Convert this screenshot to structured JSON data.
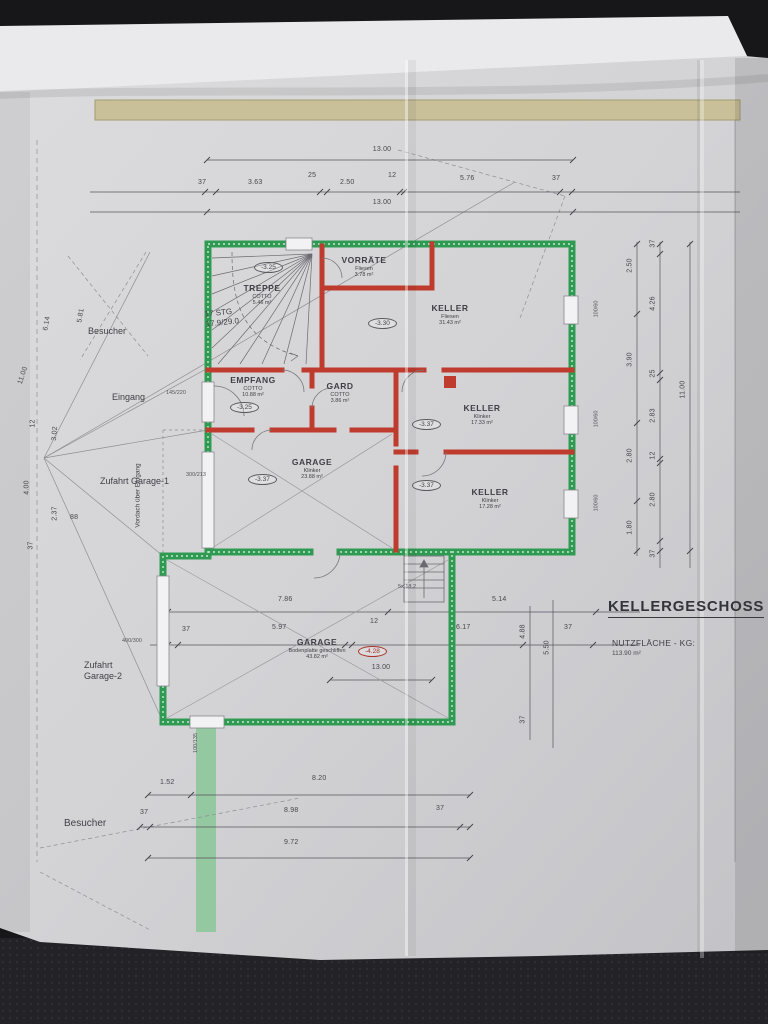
{
  "drawing": {
    "title": "KELLERGESCHOSS",
    "area_label": "NUTZFLÄCHE - KG:",
    "area_value": "113.90 m²"
  },
  "rooms": [
    {
      "name": "TREPPE",
      "finish": "COTTO",
      "area": "5.46 m²",
      "level": "-3.25"
    },
    {
      "name": "VORRÄTE",
      "finish": "Fliesen",
      "area": "3.78 m²"
    },
    {
      "name": "KELLER",
      "finish": "Fliesen",
      "area": "31.43 m²",
      "level": "-3.30"
    },
    {
      "name": "EMPFANG",
      "finish": "COTTO",
      "area": "10.88 m²",
      "level": "-3.25"
    },
    {
      "name": "GARD",
      "finish": "COTTO",
      "area": "3.86 m²"
    },
    {
      "name": "KELLER",
      "finish": "Klinker",
      "area": "17.33 m²",
      "level": "-3.37"
    },
    {
      "name": "GARAGE",
      "finish": "Klinker",
      "area": "23.88 m²",
      "level": "-3.37"
    },
    {
      "name": "KELLER",
      "finish": "Klinker",
      "area": "17.28 m²",
      "level": "-3.37"
    },
    {
      "name": "GARAGE",
      "finish": "Bodenplatte geschliffen",
      "area": "43.82 m²",
      "level": "-4.28"
    }
  ],
  "stair": {
    "count": "17 STG",
    "rise_run": "17.9/29.0",
    "outside_steps": "5x 18.2"
  },
  "site": {
    "besucher_top": "Besucher",
    "eingang": "Eingang",
    "zufahrt_garage_1": "Zufahrt Garage-1",
    "vordach": "Vordach über Eingang",
    "zufahrt_garage_2": "Zufahrt Garage-2",
    "besucher_bottom": "Besucher"
  },
  "dims": {
    "top": {
      "total": "13.00",
      "segments": [
        "37",
        "3.63",
        "25",
        "2.50",
        "12",
        "5.76",
        "37"
      ],
      "total2": "13.00"
    },
    "right": {
      "inner": [
        "2.50",
        "3.90",
        "2.80",
        "1.80"
      ],
      "chain": [
        "37",
        "4.26",
        "25",
        "2.83",
        "12",
        "2.80",
        "37"
      ],
      "overall": "11.00"
    },
    "left": {
      "overall": "11.00",
      "diagonals": [
        "6.14",
        "5.81"
      ],
      "chain": [
        "12",
        "3.02",
        "4.00",
        "2.37",
        "37"
      ],
      "offset": "88"
    },
    "garage_row": {
      "upper": [
        "7.86",
        "5.14"
      ],
      "lower": [
        "37",
        "5.97",
        "12",
        "6.17"
      ],
      "vertical": [
        "4.88",
        "5.50"
      ],
      "side": "37",
      "below": "37",
      "total": "13.00"
    },
    "bottom": {
      "row1": [
        "1.52",
        "8.20"
      ],
      "row2": [
        "37",
        "8.98",
        "37"
      ],
      "row3": "9.72"
    }
  },
  "openings": {
    "entrance_door": "145/220",
    "garage1_door": "300/213",
    "garage2_door": "400/300",
    "window_right": "100/60",
    "window_bottom": "100/135"
  },
  "colors": {
    "outer_wall": "#2f9b52",
    "inner_wall": "#bf3b2d",
    "band": "#c9c09a",
    "path": "#8cc79a"
  }
}
